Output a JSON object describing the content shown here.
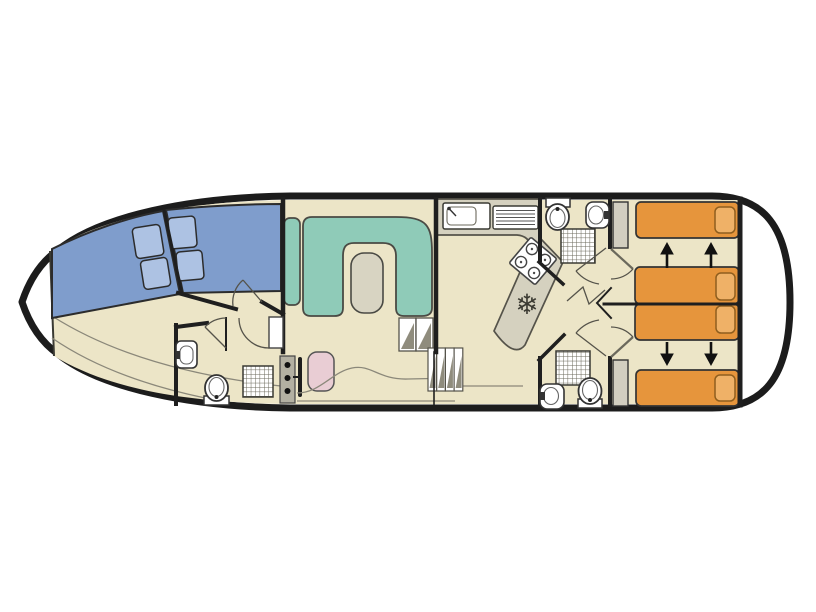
{
  "meta": {
    "type": "boat-floor-plan",
    "view": "top-down",
    "orientation": "bow-left-stern-right"
  },
  "canvas": {
    "width": 816,
    "height": 612,
    "background": "#ffffff"
  },
  "colors": {
    "hull_outline": "#1c1c1c",
    "deck": "#ffffff",
    "floor": "#ece5c7",
    "wall": "#1f1f1f",
    "bed_blue": "#7f9dcc",
    "pillow_blue": "#adc2e3",
    "sofa_teal": "#8fcbb8",
    "table_gray": "#d8d4c2",
    "counter_gray": "#d5d1bf",
    "counter_edge": "#55534a",
    "bed_orange": "#e6953c",
    "pillow_orange": "#efb167",
    "pillow_orange_edge": "#8f5e1e",
    "wardrobe_gray": "#d2cec0",
    "helm_seat_pink": "#e9cdd4",
    "helm_console_gray": "#b3b0a2",
    "fixture_white": "#ffffff",
    "step_hatch": "#8f8c7d",
    "arrow_black": "#111111",
    "icon_dark": "#3c3b33"
  },
  "icons": {
    "snowflake": "❄"
  },
  "components": {
    "bow_cabin": {
      "beds": 2,
      "pillows": 4
    },
    "saloon": {
      "sofa": "U-shaped",
      "side_cushion": 1,
      "table": 1
    },
    "helm": {
      "seat": 1,
      "console_knobs": 3,
      "steering_wheel": 1
    },
    "galley": {
      "sink": 1,
      "drainboard": 1,
      "stove_burners": 4,
      "fridge_snowflake": 1
    },
    "stairs": {
      "flights": 2,
      "steps_per_flight": [
        2,
        4
      ]
    },
    "bathrooms": [
      {
        "position": "bow",
        "toilet": 1,
        "washbasin": 1,
        "shower": 1
      },
      {
        "position": "aft-top",
        "toilet": 1,
        "washbasin": 1,
        "shower": 1
      },
      {
        "position": "aft-bottom",
        "toilet": 1,
        "washbasin": 1,
        "shower": 1
      }
    ],
    "aft_cabins": {
      "cabins": 2,
      "single_beds": 2,
      "sliding_double_beds": 2,
      "wardrobes": 2,
      "slide_arrows": 4
    }
  }
}
